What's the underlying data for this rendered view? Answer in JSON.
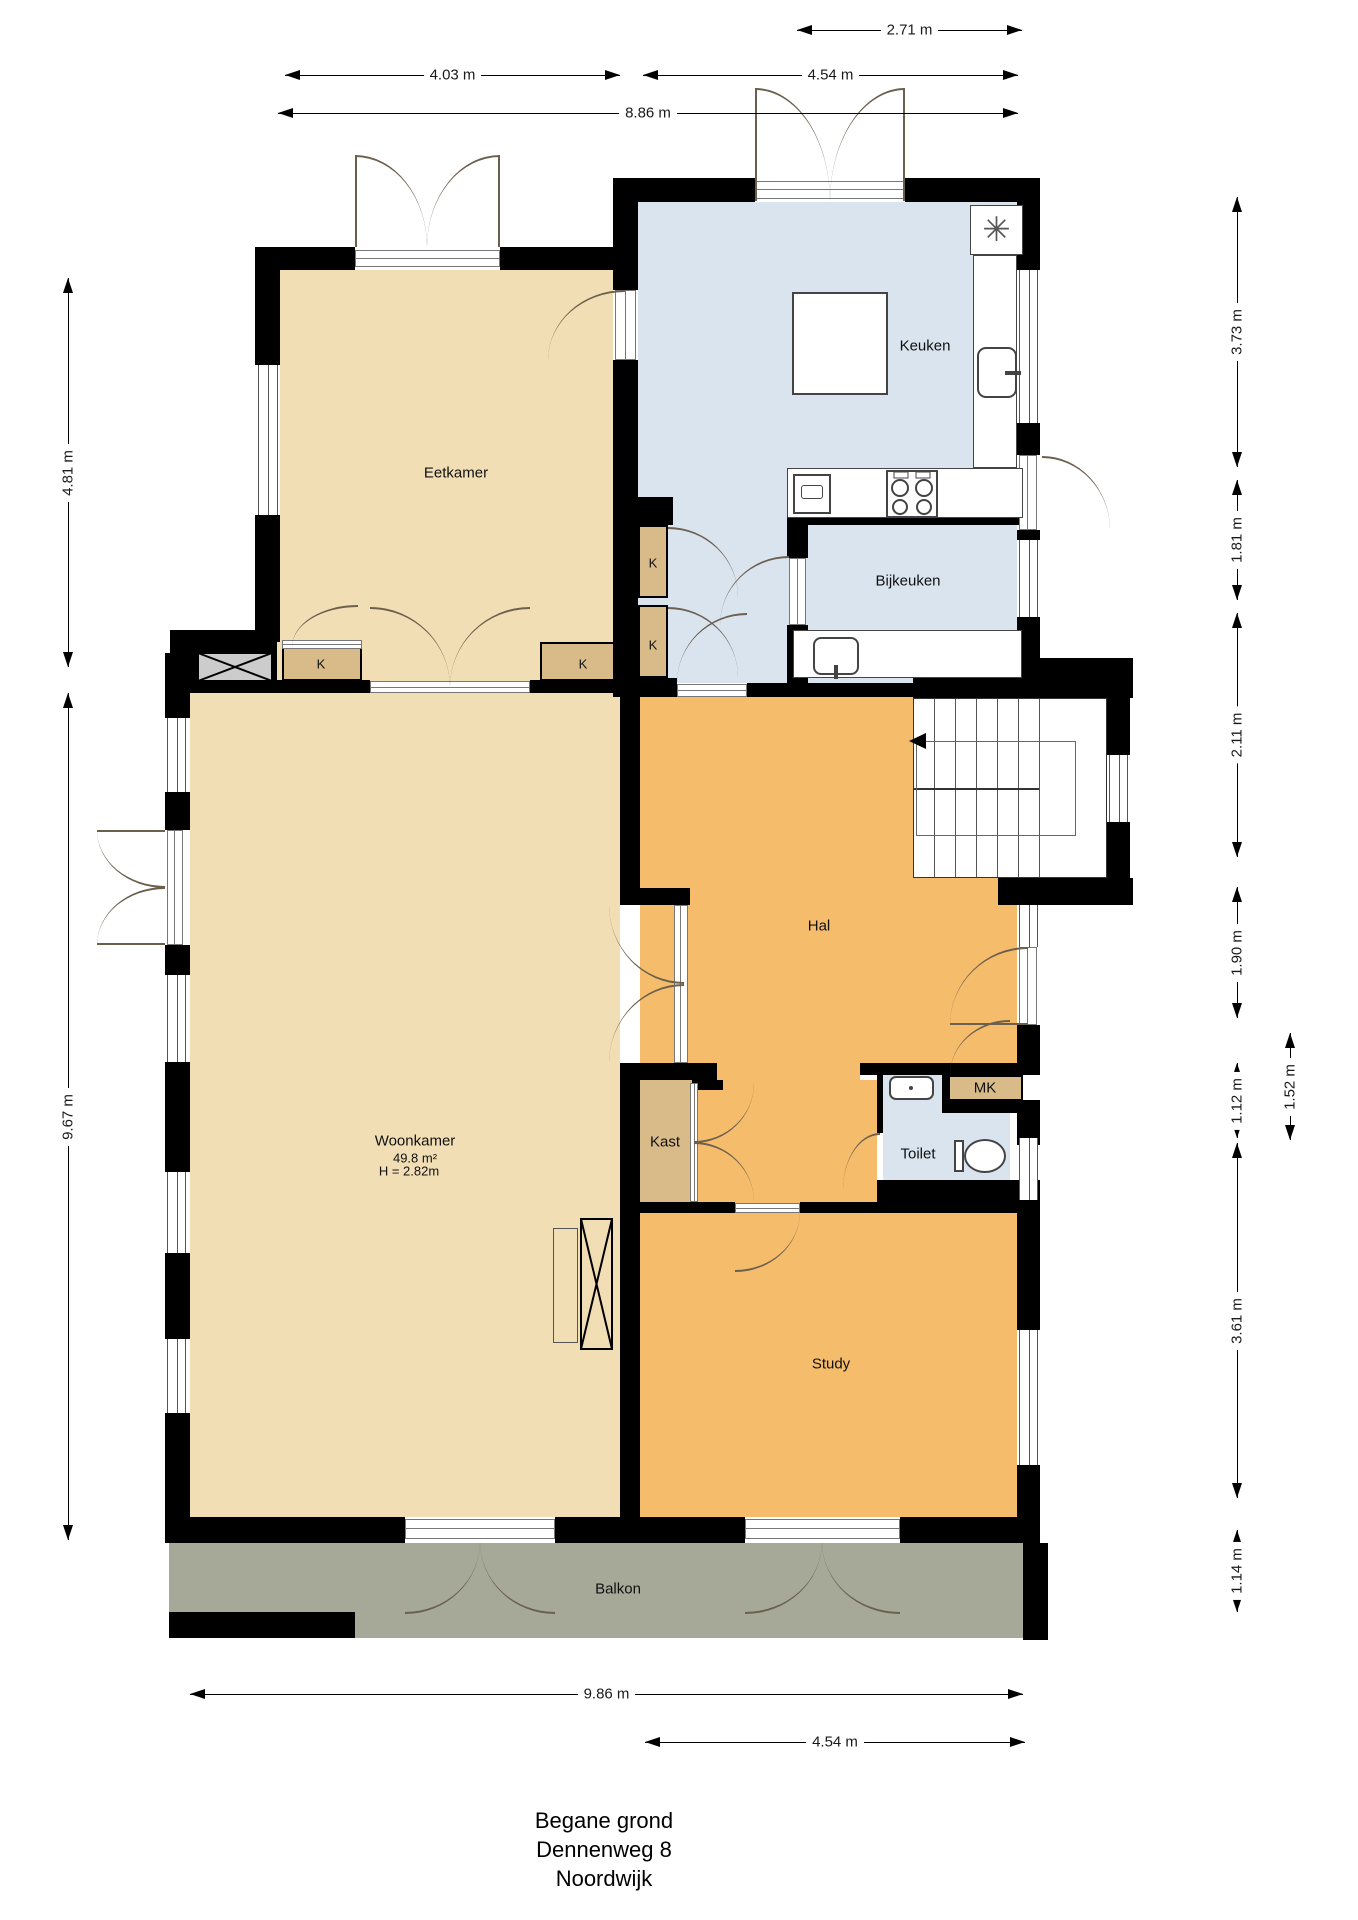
{
  "title": [
    "Begane grond",
    "Dennenweg 8",
    "Noordwijk"
  ],
  "rooms": {
    "eetkamer": "Eetkamer",
    "keuken": "Keuken",
    "bijkeuken": "Bijkeuken",
    "hal": "Hal",
    "woonkamer": "Woonkamer",
    "woonkamer_area": "49.8 m²",
    "woonkamer_height": "H = 2.82m",
    "kast": "Kast",
    "toilet": "Toilet",
    "study": "Study",
    "balkon": "Balkon",
    "mk": "MK",
    "k": "K"
  },
  "dims": {
    "d271": "2.71 m",
    "d403": "4.03 m",
    "d454": "4.54 m",
    "d886": "8.86 m",
    "d986": "9.86 m",
    "d481": "4.81 m",
    "d967": "9.67 m",
    "d373": "3.73 m",
    "d181": "1.81 m",
    "d211": "2.11 m",
    "d190": "1.90 m",
    "d112": "1.12 m",
    "d152": "1.52 m",
    "d361": "3.61 m",
    "d114": "1.14 m"
  },
  "colors": {
    "wall": "#000000",
    "living_tan": "#F2DEB5",
    "hall_orange": "#F5BC6C",
    "kitchen_blue": "#D9E4EF",
    "closet_tan": "#D8BB89",
    "balcony_grey": "#A6A997",
    "chimney_grey": "#CCCCCC"
  },
  "icons": {
    "extractor": "✳"
  }
}
